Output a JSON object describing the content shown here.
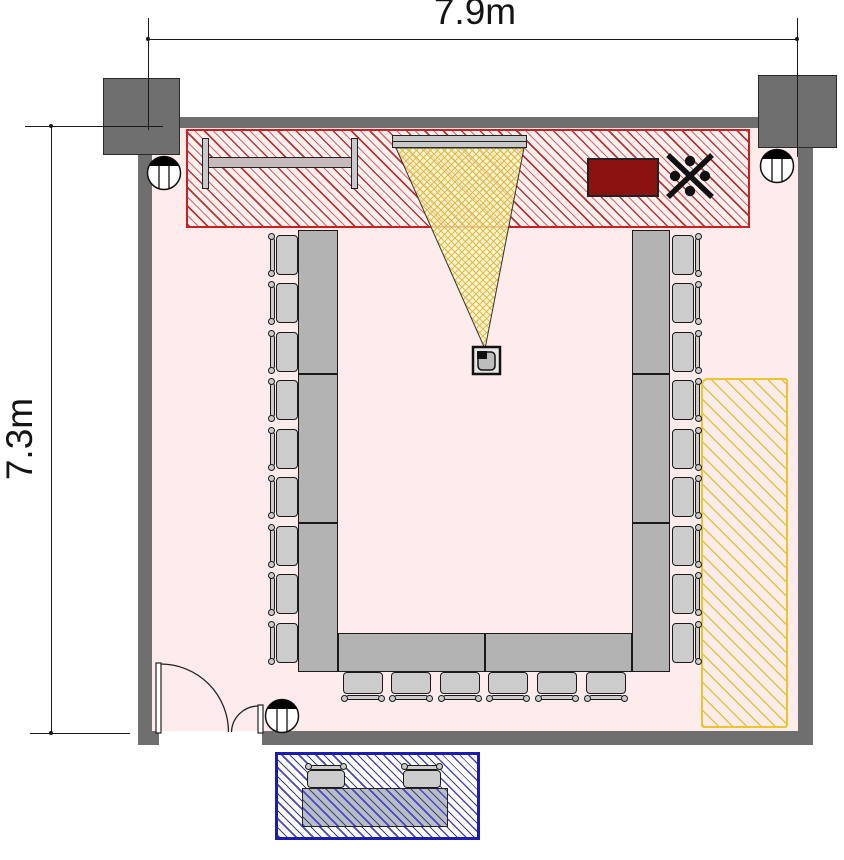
{
  "title": "meeting-room-floor-plan",
  "dimensions": {
    "width_label": "7.9m",
    "height_label": "7.3m"
  },
  "colors": {
    "wall": "#6f6f6f",
    "room": "#fdeceb",
    "redb": "#cc2020",
    "redh": "#bb3434",
    "yellowb": "#ecc62d",
    "yellowh": "#e6c53e",
    "blueb": "#1c1cb0",
    "blueh": "#4848c0",
    "table": "#b3b3b3",
    "chair": "#cccccc",
    "cabinet": "#8c1212",
    "cone_fill": "#fdf7cf",
    "cone_hatch": "#ddb93c"
  },
  "furniture": {
    "chairs_left": 9,
    "chairs_right": 9,
    "chairs_bottom": 6,
    "table_segments_left": 3,
    "table_segments_right": 3,
    "table_segments_bottom": 2,
    "outside_stools": 2,
    "outside_tables": 1
  },
  "equipment": {
    "items": [
      "whiteboard",
      "projector-screen",
      "projection-cone",
      "projector",
      "equipment-cabinet",
      "ceiling-fan-symbol",
      "sprinkler-symbol",
      "double-entrance-door"
    ],
    "sprinkler_count": 3
  }
}
